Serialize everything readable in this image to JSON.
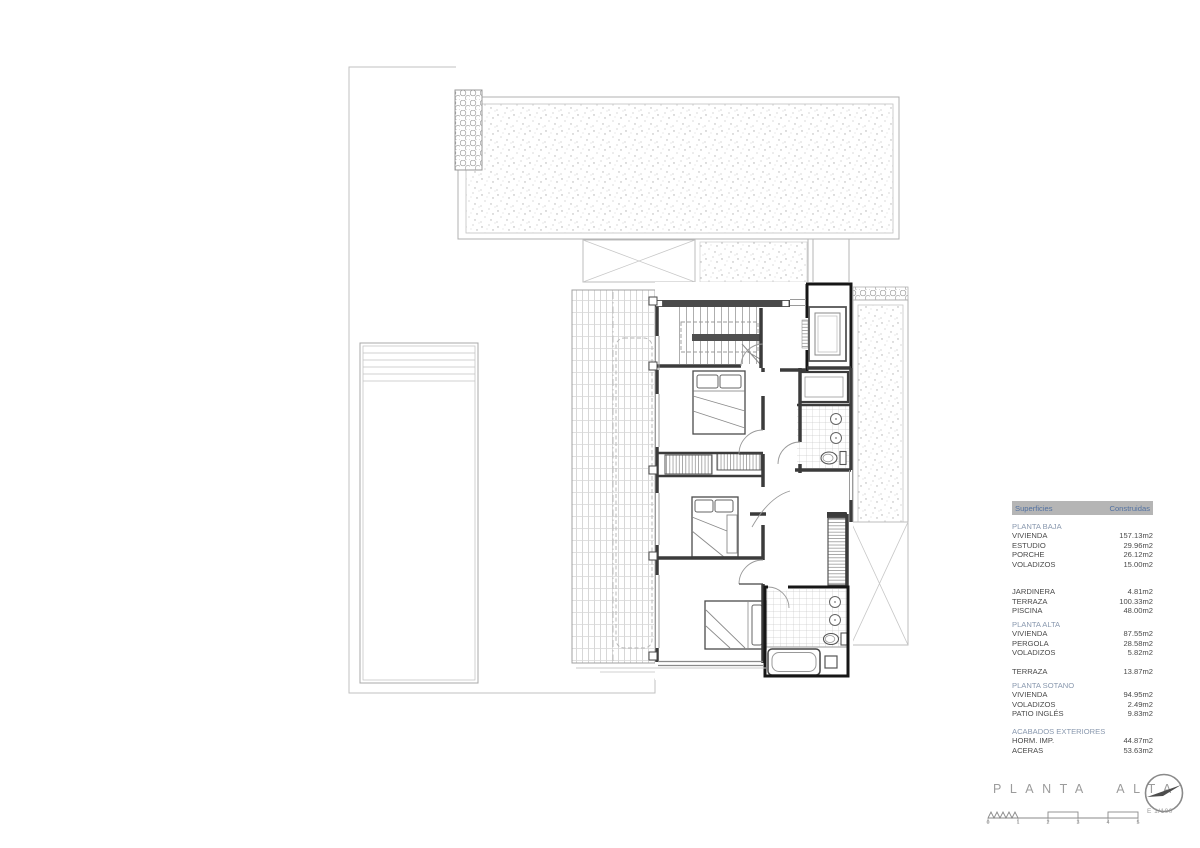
{
  "table": {
    "header": {
      "col1": "Superficies",
      "col2": "Construidas"
    },
    "sections": [
      {
        "title": "PLANTA BAJA",
        "rows": [
          [
            "VIVIENDA",
            "157.13m2"
          ],
          [
            "ESTUDIO",
            "29.96m2"
          ],
          [
            "PORCHE",
            "26.12m2"
          ],
          [
            "VOLADIZOS",
            "15.00m2"
          ]
        ]
      },
      {
        "title": "",
        "rows": [
          [
            "JARDINERA",
            "4.81m2"
          ],
          [
            "TERRAZA",
            "100.33m2"
          ],
          [
            "PISCINA",
            "48.00m2"
          ]
        ]
      },
      {
        "title": "PLANTA ALTA",
        "rows": [
          [
            "VIVIENDA",
            "87.55m2"
          ],
          [
            "PERGOLA",
            "28.58m2"
          ],
          [
            "VOLADIZOS",
            "5.82m2"
          ]
        ]
      },
      {
        "title": "",
        "rows": [
          [
            "TERRAZA",
            "13.87m2"
          ]
        ]
      },
      {
        "title": "PLANTA SOTANO",
        "rows": [
          [
            "VIVIENDA",
            "94.95m2"
          ],
          [
            "VOLADIZOS",
            "2.49m2"
          ],
          [
            "PATIO INGLÉS",
            "9.83m2"
          ]
        ]
      },
      {
        "title": "ACABADOS EXTERIORES",
        "rows": [
          [
            "HORM. IMP.",
            "44.87m2"
          ],
          [
            "ACERAS",
            "53.63m2"
          ]
        ]
      }
    ]
  },
  "title_block": {
    "title": "PLANTA ALTA",
    "scale_label": "E 1/100",
    "scale_ticks": [
      "0",
      "1",
      "2",
      "3",
      "4",
      "5"
    ]
  },
  "colors": {
    "header_bg": "#b5b5b5",
    "header_text": "#5271a1",
    "section_text": "#8998ae",
    "body_text": "#4a4a4a",
    "title_gray": "#9c9c9c",
    "wall_dark": "#3b3b3b"
  }
}
